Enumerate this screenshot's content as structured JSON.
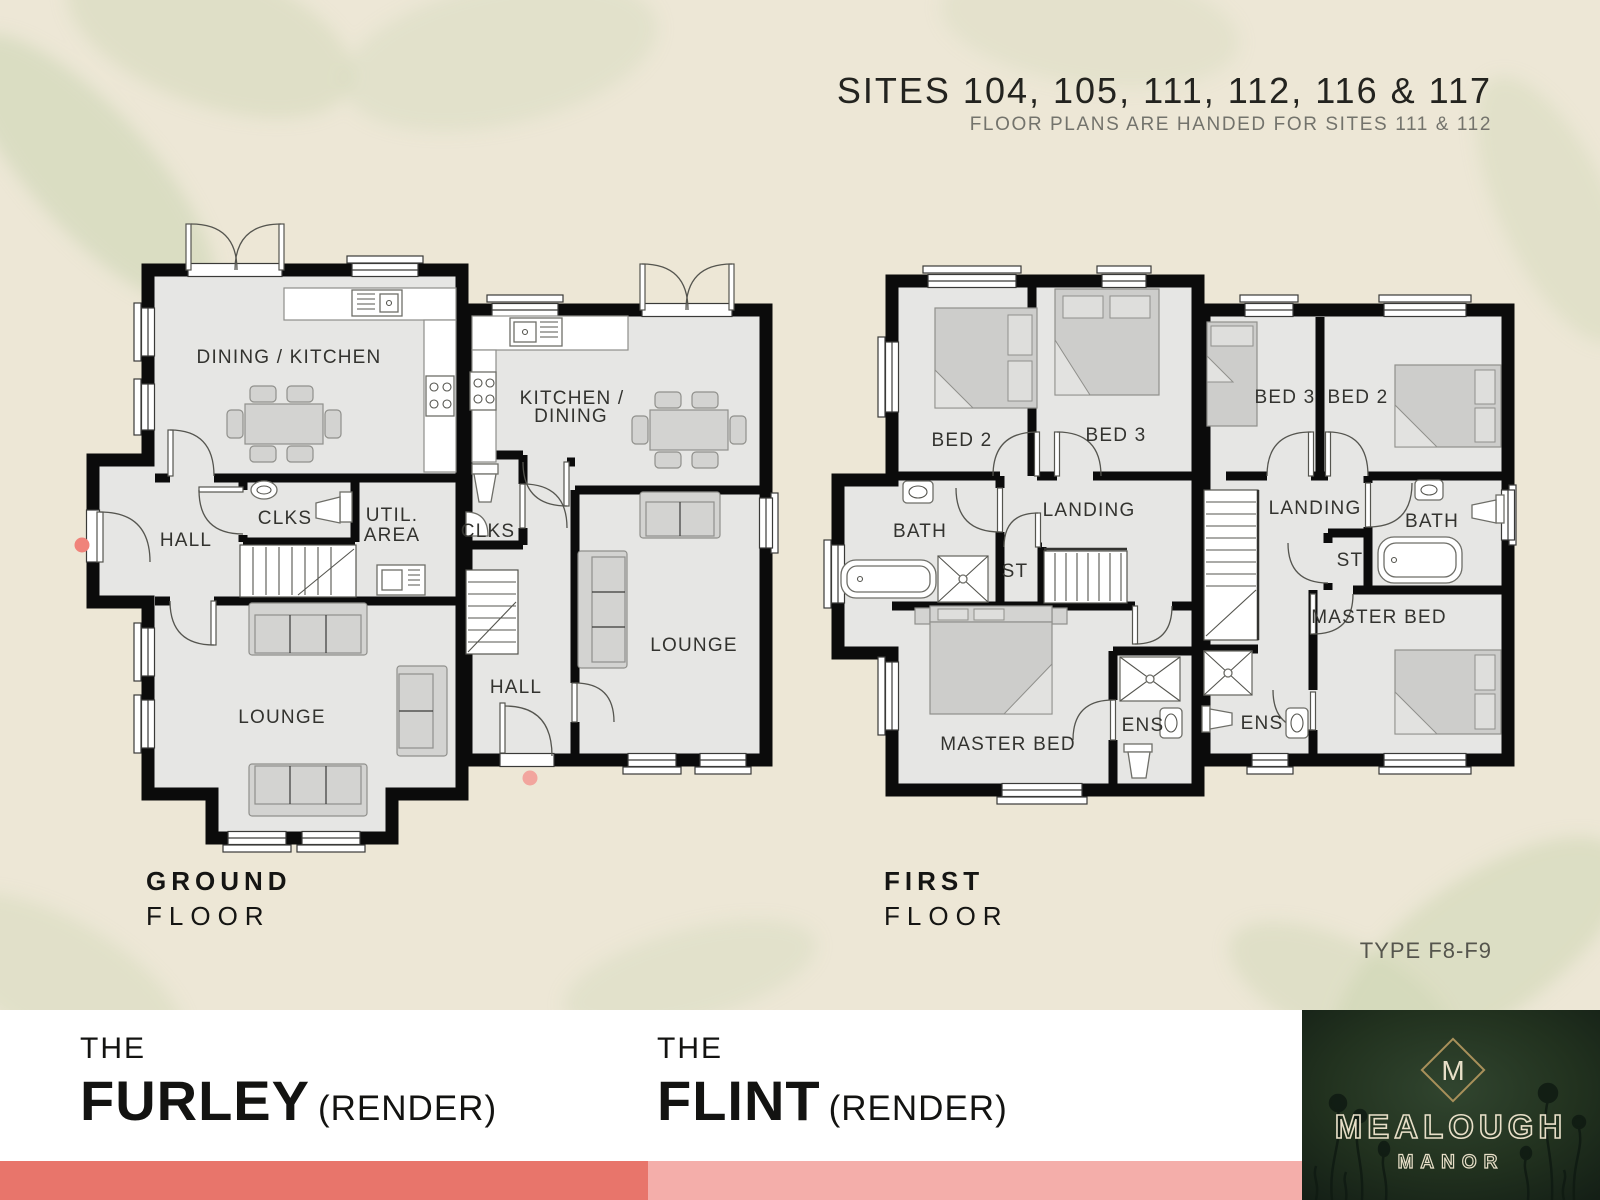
{
  "header": {
    "title": "SITES 104, 105, 111, 112, 116 & 117",
    "subtitle": "FLOOR PLANS ARE HANDED FOR SITES 111 & 112"
  },
  "floor_labels": {
    "ground": {
      "line1": "GROUND",
      "line2": "FLOOR"
    },
    "first": {
      "line1": "FIRST",
      "line2": "FLOOR"
    }
  },
  "ground_floor": {
    "furley": {
      "dining_kitchen": "DINING / KITCHEN",
      "hall": "HALL",
      "clks": "CLKS",
      "util_line1": "UTIL.",
      "util_line2": "AREA",
      "lounge": "LOUNGE"
    },
    "flint": {
      "kitchen_line1": "KITCHEN /",
      "kitchen_line2": "DINING",
      "clks": "CLKS",
      "hall": "HALL",
      "lounge": "LOUNGE"
    }
  },
  "first_floor": {
    "furley": {
      "bed2": "BED 2",
      "bed3": "BED 3",
      "bath": "BATH",
      "landing": "LANDING",
      "st": "ST",
      "master": "MASTER BED",
      "ens": "ENS"
    },
    "flint": {
      "bed3": "BED 3",
      "bed2": "BED 2",
      "landing": "LANDING",
      "st": "ST",
      "bath": "BATH",
      "master": "MASTER BED",
      "ens": "ENS"
    }
  },
  "houses": {
    "furley": {
      "the": "THE",
      "name": "FURLEY",
      "suffix": "(RENDER)"
    },
    "flint": {
      "the": "THE",
      "name": "FLINT",
      "suffix": "(RENDER)"
    }
  },
  "type_label": "TYPE F8-F9",
  "brand": {
    "monogram": "M",
    "name": "MEALOUGH",
    "subname": "MANOR"
  },
  "colors": {
    "coral_strip": "#E8756B",
    "pink_strip": "#F4AEAA",
    "dot_furley": "#F0837A",
    "dot_flint": "#F2A59E"
  }
}
